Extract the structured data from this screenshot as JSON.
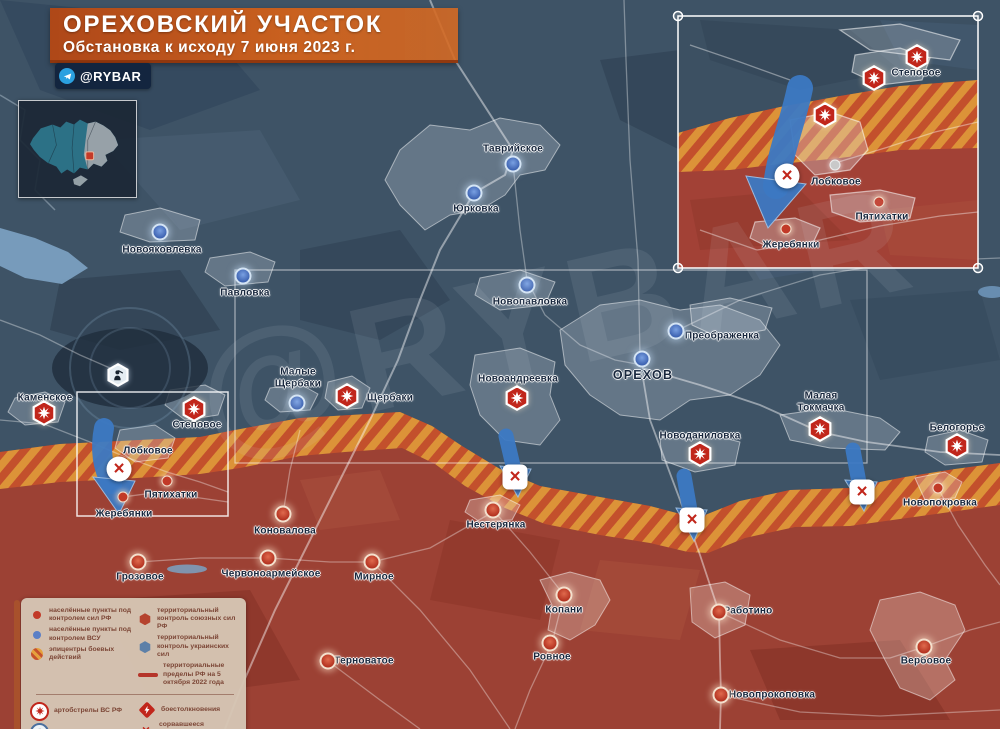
{
  "header": {
    "title": "ОРЕХОВСКИЙ УЧАСТОК",
    "subtitle": "Обстановка к исходу 7 июня 2023 г.",
    "channel": "@RYBAR",
    "watermark": "@RYBAR"
  },
  "colors": {
    "ua_territory": "#3e5366",
    "ru_territory": "#9c4134",
    "stripe_orange": "#df9738",
    "stripe_red": "#c5512c",
    "banner_orange": "#cc5f1d",
    "combat_red": "#c1261b",
    "arrow_blue": "#3c79c3"
  },
  "legend": {
    "col1": [
      {
        "icon": "ru-dot",
        "label": "населённые пункты под контролем сил РФ"
      },
      {
        "icon": "ua-dot",
        "label": "населённые пункты под контролем ВСУ"
      },
      {
        "icon": "stripe-circle",
        "label": "эпицентры боевых действий"
      }
    ],
    "col2": [
      {
        "icon": "ru-hex",
        "label": "территориальный контроль союзных сил РФ"
      },
      {
        "icon": "ua-hex",
        "label": "территориальный контроль украинских сил"
      },
      {
        "icon": "red-line",
        "label": "территориальные пределы РФ на 5 октября 2022 года"
      }
    ],
    "col3": [
      {
        "icon": "shelling",
        "label": "артобстрелы ВС РФ"
      },
      {
        "icon": "afu-unit",
        "label": "отряды ВСУ"
      }
    ],
    "col4": [
      {
        "icon": "clash",
        "label": "боестолкновения"
      },
      {
        "icon": "failed",
        "label": "сорвавшееся наступление"
      }
    ]
  },
  "map": {
    "labels": [
      {
        "text": "Таврийское",
        "x": 513,
        "y": 149
      },
      {
        "text": "Юрковка",
        "x": 476,
        "y": 209
      },
      {
        "text": "Новояковлевка",
        "x": 162,
        "y": 250
      },
      {
        "text": "Павловка",
        "x": 245,
        "y": 293
      },
      {
        "text": "Новопавловка",
        "x": 530,
        "y": 302
      },
      {
        "text": "Преображенка",
        "x": 722,
        "y": 336
      },
      {
        "text": "ОРЕХОВ",
        "x": 643,
        "y": 375,
        "big": true
      },
      {
        "text": "Малые\nЩербаки",
        "x": 298,
        "y": 378
      },
      {
        "text": "Щербаки",
        "x": 390,
        "y": 398
      },
      {
        "text": "Новоандреевка",
        "x": 518,
        "y": 379
      },
      {
        "text": "Каменское",
        "x": 45,
        "y": 398
      },
      {
        "text": "Степовое",
        "x": 197,
        "y": 425
      },
      {
        "text": "Лобковое",
        "x": 148,
        "y": 451
      },
      {
        "text": "Пятихатки",
        "x": 171,
        "y": 495
      },
      {
        "text": "Жеребянки",
        "x": 124,
        "y": 514
      },
      {
        "text": "Новоданиловка",
        "x": 700,
        "y": 436
      },
      {
        "text": "Малая\nТокмачка",
        "x": 821,
        "y": 402
      },
      {
        "text": "Белогорье",
        "x": 957,
        "y": 428
      },
      {
        "text": "Новопокровка",
        "x": 940,
        "y": 503
      },
      {
        "text": "Нестерянка",
        "x": 496,
        "y": 525
      },
      {
        "text": "Коновалова",
        "x": 285,
        "y": 531
      },
      {
        "text": "Грозовое",
        "x": 140,
        "y": 577
      },
      {
        "text": "Червоноармейское",
        "x": 271,
        "y": 574
      },
      {
        "text": "Мирное",
        "x": 374,
        "y": 577
      },
      {
        "text": "Копани",
        "x": 564,
        "y": 610
      },
      {
        "text": "Работино",
        "x": 748,
        "y": 611
      },
      {
        "text": "Ровное",
        "x": 552,
        "y": 657
      },
      {
        "text": "Терноватое",
        "x": 364,
        "y": 661
      },
      {
        "text": "Новопрокоповка",
        "x": 772,
        "y": 695
      },
      {
        "text": "Вербовое",
        "x": 926,
        "y": 661
      },
      {
        "text": "Степовое",
        "x": 916,
        "y": 73
      },
      {
        "text": "Лобковое",
        "x": 836,
        "y": 182
      },
      {
        "text": "Пятихатки",
        "x": 882,
        "y": 217
      },
      {
        "text": "Жеребянки",
        "x": 791,
        "y": 245
      }
    ],
    "markers": [
      {
        "type": "ua-dot",
        "x": 513,
        "y": 164
      },
      {
        "type": "ua-dot",
        "x": 474,
        "y": 193
      },
      {
        "type": "ua-dot",
        "x": 160,
        "y": 232
      },
      {
        "type": "ua-dot",
        "x": 243,
        "y": 276
      },
      {
        "type": "ua-dot",
        "x": 527,
        "y": 285
      },
      {
        "type": "ua-dot",
        "x": 676,
        "y": 331
      },
      {
        "type": "ua-dot",
        "x": 642,
        "y": 359
      },
      {
        "type": "ua-dot",
        "x": 297,
        "y": 403
      },
      {
        "type": "ru-hex",
        "x": 347,
        "y": 396
      },
      {
        "type": "ru-hex",
        "x": 517,
        "y": 398
      },
      {
        "type": "ru-hex",
        "x": 44,
        "y": 413
      },
      {
        "type": "ru-hex",
        "x": 194,
        "y": 409
      },
      {
        "type": "ru-hex",
        "x": 700,
        "y": 454
      },
      {
        "type": "ru-hex",
        "x": 820,
        "y": 429
      },
      {
        "type": "ru-hex",
        "x": 957,
        "y": 446
      },
      {
        "type": "ru-hex",
        "x": 917,
        "y": 57
      },
      {
        "type": "ru-hex",
        "x": 874,
        "y": 78
      },
      {
        "type": "ru-hex",
        "x": 825,
        "y": 115
      },
      {
        "type": "ru-dot-s",
        "x": 167,
        "y": 481
      },
      {
        "type": "ru-dot-s",
        "x": 123,
        "y": 497
      },
      {
        "type": "ru-dot-s",
        "x": 938,
        "y": 488
      },
      {
        "type": "ru-dot-s",
        "x": 879,
        "y": 202
      },
      {
        "type": "ru-dot-s",
        "x": 786,
        "y": 229
      },
      {
        "type": "gray-dot",
        "x": 835,
        "y": 165
      },
      {
        "type": "ru-dot",
        "x": 493,
        "y": 510
      },
      {
        "type": "ru-dot",
        "x": 283,
        "y": 514
      },
      {
        "type": "ru-dot",
        "x": 138,
        "y": 562
      },
      {
        "type": "ru-dot",
        "x": 268,
        "y": 558
      },
      {
        "type": "ru-dot",
        "x": 372,
        "y": 562
      },
      {
        "type": "ru-dot",
        "x": 564,
        "y": 595
      },
      {
        "type": "ru-dot",
        "x": 719,
        "y": 612
      },
      {
        "type": "ru-dot",
        "x": 550,
        "y": 643
      },
      {
        "type": "ru-dot",
        "x": 328,
        "y": 661
      },
      {
        "type": "ru-dot",
        "x": 721,
        "y": 695
      },
      {
        "type": "ru-dot",
        "x": 924,
        "y": 647
      },
      {
        "type": "afu-hex",
        "x": 118,
        "y": 375
      },
      {
        "type": "x-circle",
        "x": 119,
        "y": 469
      },
      {
        "type": "x-square",
        "x": 515,
        "y": 477
      },
      {
        "type": "x-square",
        "x": 692,
        "y": 520
      },
      {
        "type": "x-square",
        "x": 862,
        "y": 492
      },
      {
        "type": "x-circle",
        "x": 787,
        "y": 176
      }
    ]
  }
}
